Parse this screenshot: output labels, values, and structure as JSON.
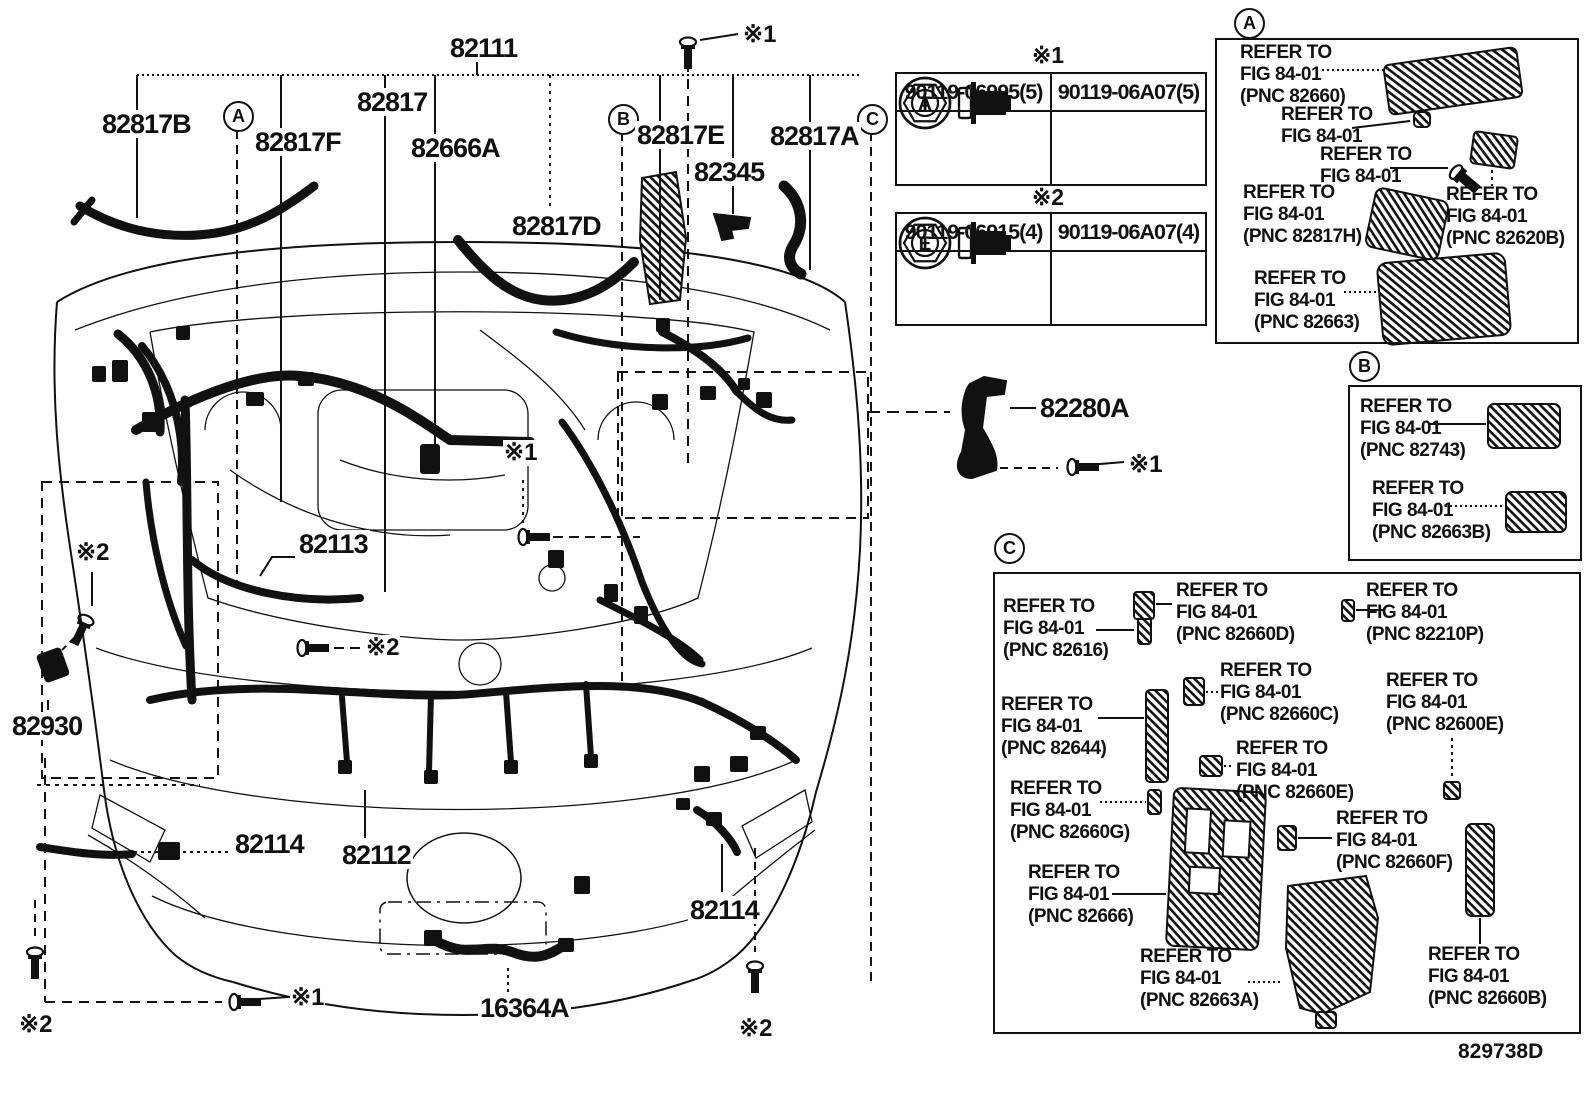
{
  "figure_code": "829738D",
  "labels": {
    "p82111": "82111",
    "p82817": "82817",
    "p82817b": "82817B",
    "p82817f": "82817F",
    "p82666a": "82666A",
    "p82817e": "82817E",
    "p82817a": "82817A",
    "p82345": "82345",
    "p82817d": "82817D",
    "p82113": "82113",
    "p82930": "82930",
    "p82114_left": "82114",
    "p82112": "82112",
    "p82114_right": "82114",
    "p16364a": "16364A",
    "p82280a": "82280A",
    "ref1": "※1",
    "ref2": "※2"
  },
  "markers": {
    "a": "A",
    "b": "B",
    "c": "C"
  },
  "tables": {
    "t1": {
      "note": "※1",
      "col1_part": "90119-06995(5)",
      "col1_head": "A",
      "col2_part": "90119-06A07(5)",
      "col2_head": "T"
    },
    "t2": {
      "note": "※2",
      "col1_part": "90119-06915(4)",
      "col1_head": "E",
      "col2_part": "90119-06A07(4)",
      "col2_head": "T"
    }
  },
  "sections": {
    "a": {
      "e_82660": "REFER TO\nFIG 84-01\n(PNC 82660)",
      "e_nut": "REFER TO\nFIG 84-01",
      "e_screw": "REFER TO\nFIG 84-01",
      "e_82817h": "REFER TO\nFIG 84-01\n(PNC 82817H)",
      "e_82620b": "REFER TO\nFIG 84-01\n(PNC 82620B)",
      "e_82663": "REFER TO\nFIG 84-01\n(PNC 82663)"
    },
    "b": {
      "e_82743": "REFER TO\nFIG 84-01\n(PNC 82743)",
      "e_82663b": "REFER TO\nFIG 84-01\n(PNC 82663B)"
    },
    "c": {
      "e_82616": "REFER TO\nFIG 84-01\n(PNC 82616)",
      "e_82660d": "REFER TO\nFIG 84-01\n(PNC 82660D)",
      "e_82210p": "REFER TO\nFIG 84-01\n(PNC 82210P)",
      "e_82660c": "REFER TO\nFIG 84-01\n(PNC 82660C)",
      "e_82600e": "REFER TO\nFIG 84-01\n(PNC 82600E)",
      "e_82644": "REFER TO\nFIG 84-01\n(PNC 82644)",
      "e_82660e": "REFER TO\nFIG 84-01\n(PNC 82660E)",
      "e_82660g": "REFER TO\nFIG 84-01\n(PNC 82660G)",
      "e_82660f": "REFER TO\nFIG 84-01\n(PNC 82660F)",
      "e_82666": "REFER TO\nFIG 84-01\n(PNC 82666)",
      "e_82663a": "REFER TO\nFIG 84-01\n(PNC 82663A)",
      "e_82660b": "REFER TO\nFIG 84-01\n(PNC 82660B)"
    }
  }
}
